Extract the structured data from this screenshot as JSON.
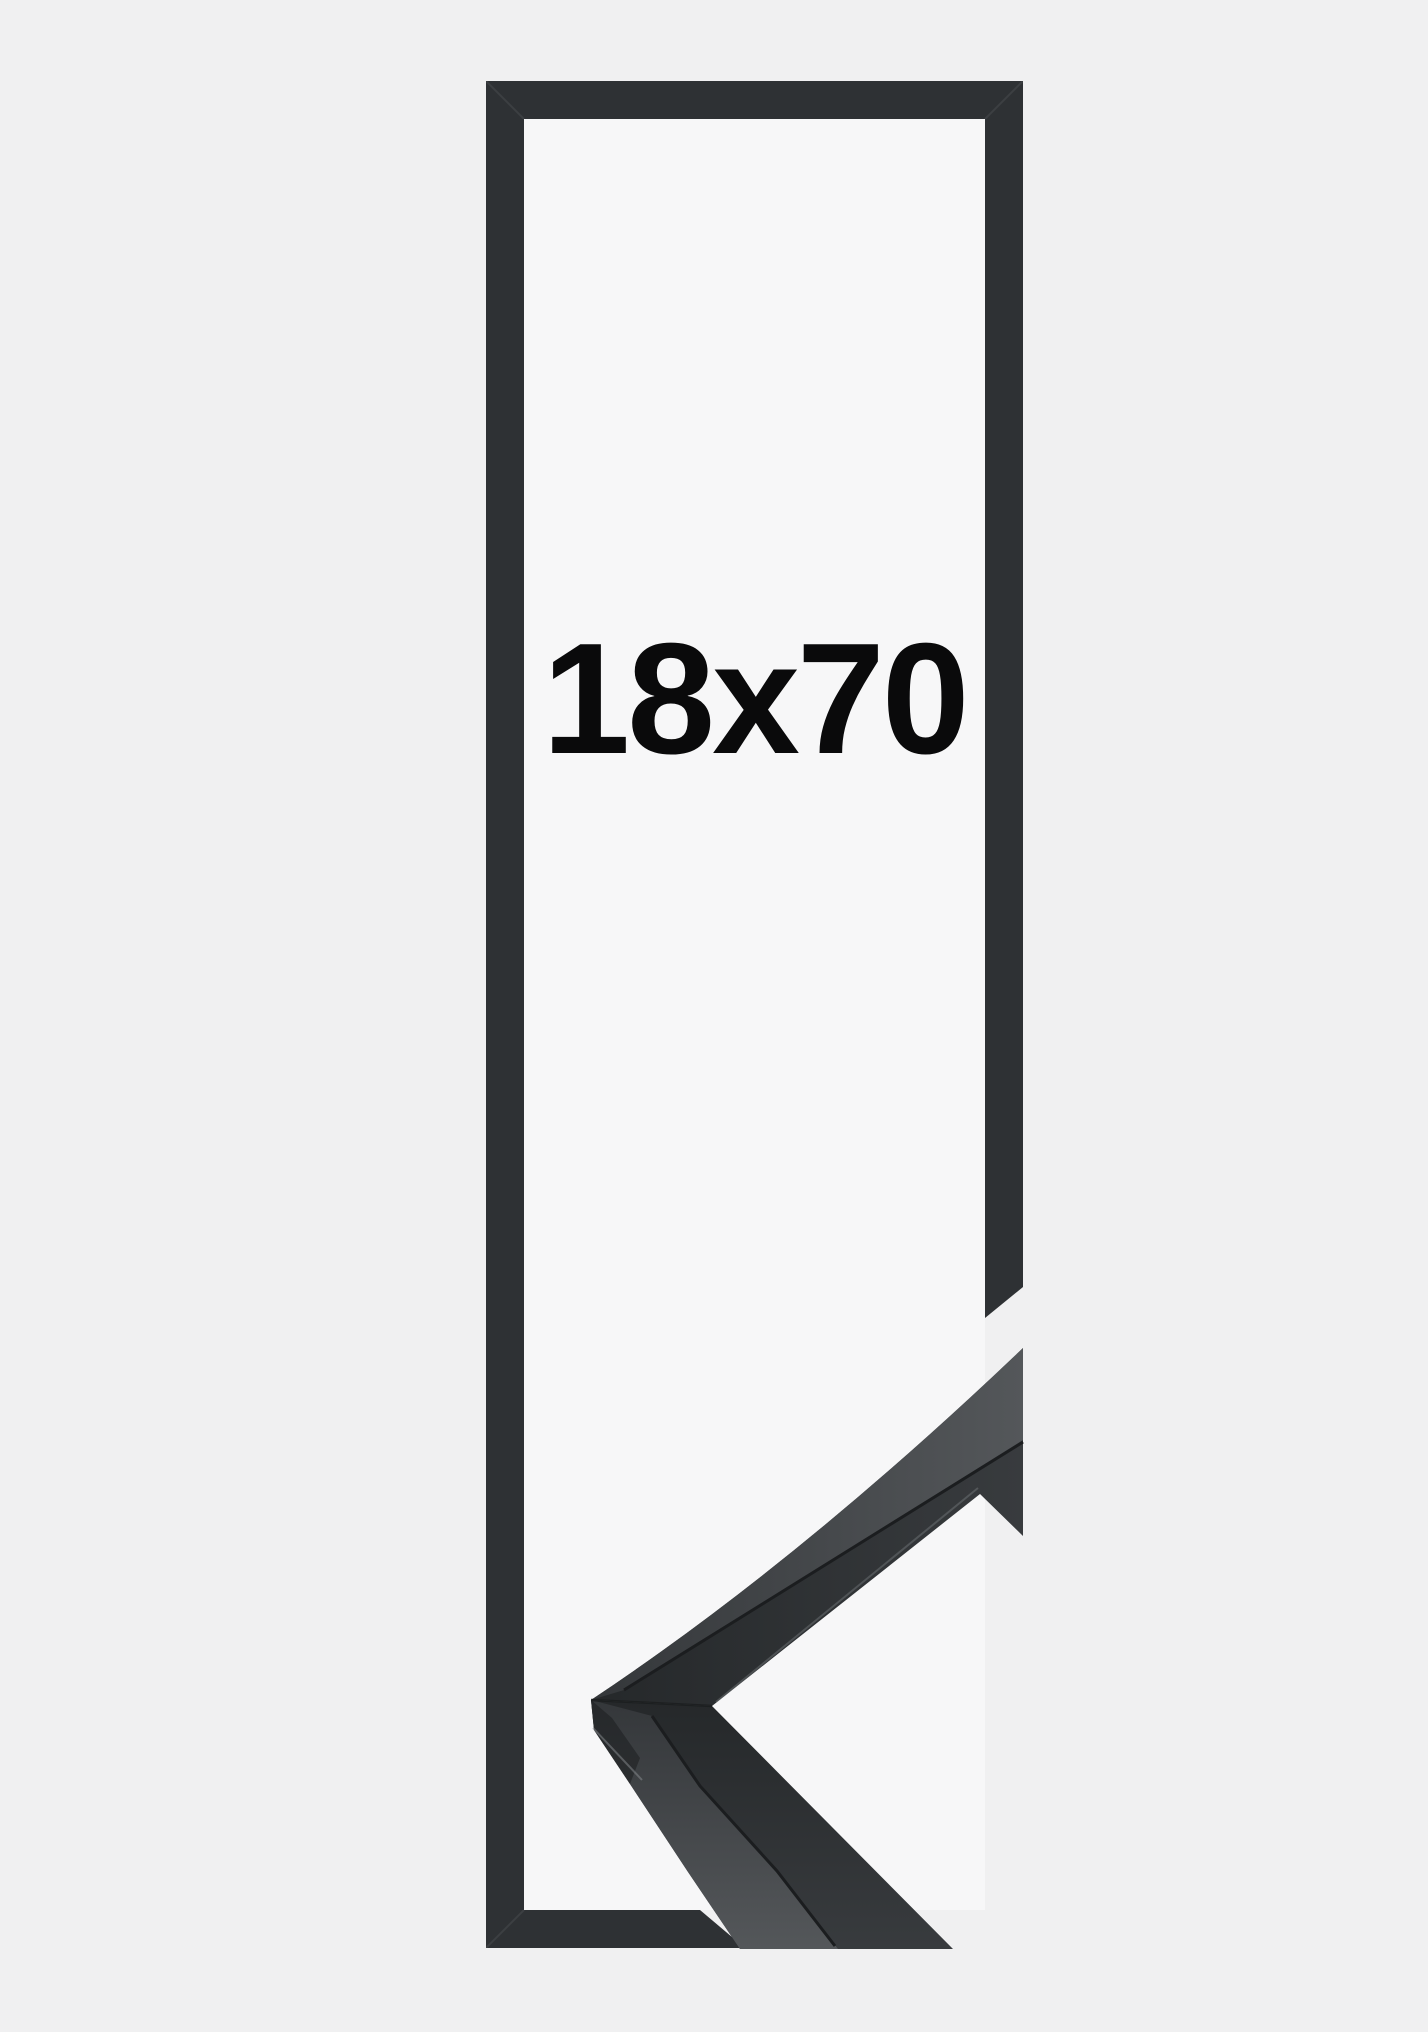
{
  "product": {
    "size_label": "18x70"
  },
  "colors": {
    "background": "#f0f0f1",
    "opening": "#f7f7f8",
    "frame": "#2e3134",
    "text": "#0a0a0b",
    "face_dark": "#25282a",
    "face_mid": "#383b3e",
    "top_dark": "#34373a",
    "top_light": "#54575a",
    "seam": "#1b1d1f",
    "highlight": "#8a8e91"
  }
}
